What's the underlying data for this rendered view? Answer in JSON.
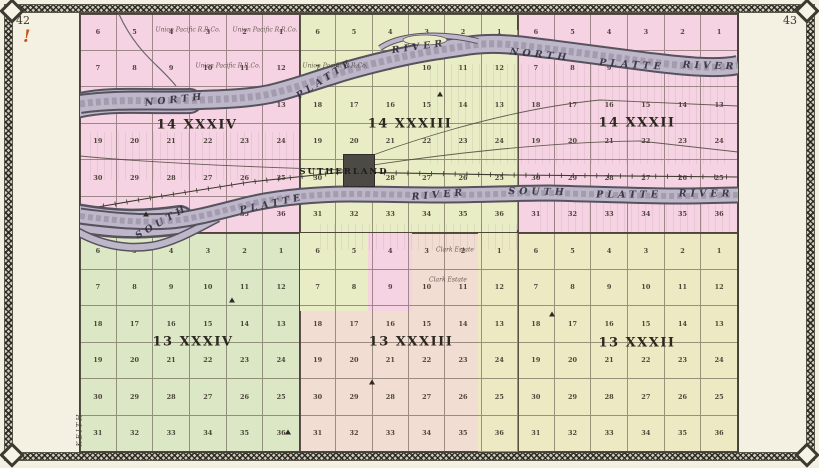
{
  "page": {
    "left_page_number": "42",
    "right_page_number": "43",
    "margin_mark": "!",
    "adjacent_county": "KEITH"
  },
  "colors": {
    "page_bg": "#f4f1e3",
    "pink": "#f6d3e2",
    "green_light": "#e9edc6",
    "sage": "#dce7c6",
    "salmon": "#f2ddd2",
    "cream": "#ede9c3",
    "river_fill": "#bdb7c9",
    "river_edge": "#56525e",
    "town_block": "#4c4a44",
    "ink": "#3a342b",
    "accent_mark": "#c25418"
  },
  "map": {
    "town": {
      "name": "SUTHERLAND"
    },
    "section_rows": [
      [
        6,
        5,
        4,
        3,
        2,
        1
      ],
      [
        7,
        8,
        9,
        10,
        11,
        12
      ],
      [
        18,
        17,
        16,
        15,
        14,
        13
      ],
      [
        19,
        20,
        21,
        22,
        23,
        24
      ],
      [
        30,
        29,
        28,
        27,
        26,
        25
      ],
      [
        31,
        32,
        33,
        34,
        35,
        36
      ]
    ],
    "townships": [
      {
        "label": "14 XXXIV",
        "x": 0,
        "y": 0,
        "w": 220,
        "h": 219,
        "color_key": "pink",
        "label_pos": [
          117,
          111
        ]
      },
      {
        "label": "14 XXXIII",
        "x": 220,
        "y": 0,
        "w": 218,
        "h": 219,
        "color_key": "green_light",
        "label_pos": [
          330,
          110
        ]
      },
      {
        "label": "14 XXXII",
        "x": 438,
        "y": 0,
        "w": 220,
        "h": 219,
        "color_key": "pink",
        "label_pos": [
          557,
          109
        ]
      },
      {
        "label": "13 XXXIV",
        "x": 0,
        "y": 219,
        "w": 220,
        "h": 219,
        "color_key": "sage",
        "label_pos": [
          113,
          328
        ]
      },
      {
        "label": "13 XXXIII",
        "x": 220,
        "y": 219,
        "w": 218,
        "h": 219,
        "color_key": "salmon",
        "label_pos": [
          331,
          328
        ]
      },
      {
        "label": "13 XXXII",
        "x": 438,
        "y": 219,
        "w": 220,
        "h": 219,
        "color_key": "cream",
        "label_pos": [
          557,
          329
        ]
      }
    ],
    "overlays": [
      {
        "x": 220,
        "y": 219,
        "w": 68,
        "h": 78,
        "color_key": "green_light"
      },
      {
        "x": 288,
        "y": 219,
        "w": 44,
        "h": 78,
        "color_key": "pink"
      },
      {
        "x": 398,
        "y": 219,
        "w": 40,
        "h": 219,
        "color_key": "cream"
      },
      {
        "x": 410,
        "y": 16,
        "w": 28,
        "h": 200,
        "color_key": "green_light"
      }
    ],
    "lot_textures": [
      {
        "x": 350,
        "y": 50,
        "w": 300,
        "h": 100
      },
      {
        "x": 460,
        "y": 186,
        "w": 196,
        "h": 32
      },
      {
        "x": 10,
        "y": 118,
        "w": 210,
        "h": 48
      },
      {
        "x": 240,
        "y": 210,
        "w": 200,
        "h": 26
      }
    ],
    "river_labels": [
      {
        "text": "NORTH",
        "x": 95,
        "y": 86,
        "rot": -6
      },
      {
        "text": "PLATTE",
        "x": 245,
        "y": 65,
        "rot": -33
      },
      {
        "text": "RIVER",
        "x": 339,
        "y": 33,
        "rot": -8
      },
      {
        "text": "NORTH",
        "x": 460,
        "y": 41,
        "rot": 6
      },
      {
        "text": "PLATTE",
        "x": 552,
        "y": 51,
        "rot": 4
      },
      {
        "text": "RIVER",
        "x": 630,
        "y": 52,
        "rot": 2
      },
      {
        "text": "SOUTH",
        "x": 82,
        "y": 208,
        "rot": -30
      },
      {
        "text": "PLATTE",
        "x": 192,
        "y": 190,
        "rot": -12
      },
      {
        "text": "RIVER",
        "x": 359,
        "y": 181,
        "rot": -5
      },
      {
        "text": "SOUTH",
        "x": 458,
        "y": 178,
        "rot": 1
      },
      {
        "text": "PLATTE",
        "x": 549,
        "y": 181,
        "rot": 0
      },
      {
        "text": "RIVER",
        "x": 626,
        "y": 180,
        "rot": 0
      }
    ],
    "tiny_labels": [
      {
        "text": "Union Pacific R.R.Co.",
        "x": 108,
        "y": 16
      },
      {
        "text": "Union Pacific R.R.Co.",
        "x": 185,
        "y": 16
      },
      {
        "text": "Union Pacific R.R.Co.",
        "x": 148,
        "y": 52
      },
      {
        "text": "Union Pacific R.R.Co.",
        "x": 255,
        "y": 52
      },
      {
        "text": "Clark Estate",
        "x": 375,
        "y": 236
      },
      {
        "text": "Clark Estate",
        "x": 368,
        "y": 266
      }
    ],
    "markers": [
      {
        "x": 66,
        "y": 200
      },
      {
        "x": 152,
        "y": 286
      },
      {
        "x": 292,
        "y": 368
      },
      {
        "x": 472,
        "y": 300
      },
      {
        "x": 208,
        "y": 418
      },
      {
        "x": 360,
        "y": 80
      }
    ]
  }
}
